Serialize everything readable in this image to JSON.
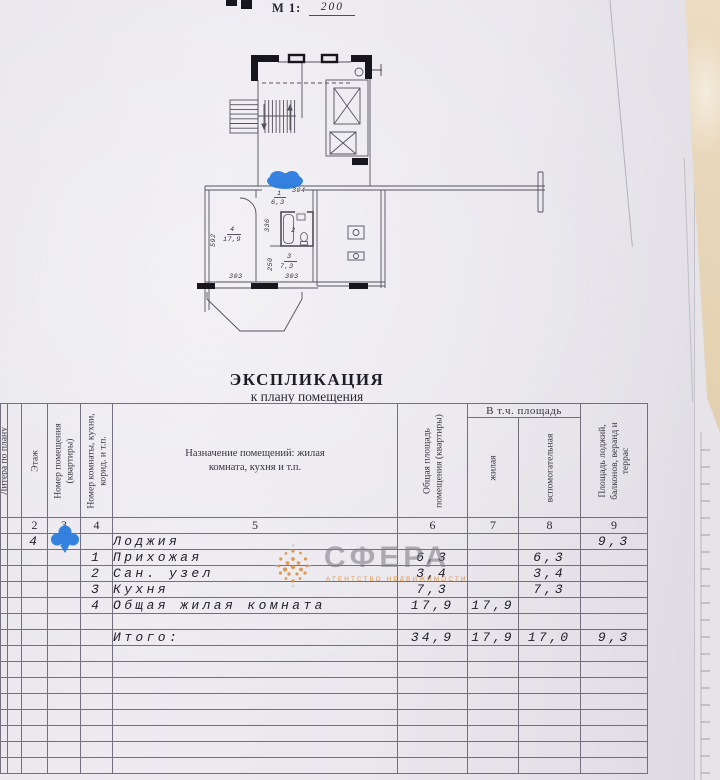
{
  "page": {
    "scale_label": "М 1:",
    "scale_value": "200",
    "title": "ЭКСПЛИКАЦИЯ",
    "subtitle": "к плану помещения"
  },
  "plan": {
    "labels": [
      {
        "t": "592",
        "x": 210,
        "y": 247,
        "r": 1
      },
      {
        "t": "4",
        "x": 230,
        "y": 226
      },
      {
        "t": "17,9",
        "x": 223,
        "y": 236
      },
      {
        "t": "303",
        "x": 229,
        "y": 273
      },
      {
        "t": "1",
        "x": 277,
        "y": 190
      },
      {
        "t": "6,3",
        "x": 271,
        "y": 199
      },
      {
        "t": "304",
        "x": 292,
        "y": 187
      },
      {
        "t": "336",
        "x": 264,
        "y": 232,
        "r": 1
      },
      {
        "t": "2",
        "x": 291,
        "y": 227
      },
      {
        "t": "250",
        "x": 267,
        "y": 271,
        "r": 1
      },
      {
        "t": "3",
        "x": 287,
        "y": 253
      },
      {
        "t": "7,3",
        "x": 280,
        "y": 263
      },
      {
        "t": "303",
        "x": 285,
        "y": 273
      }
    ]
  },
  "watermark": {
    "name": "СФЕРА",
    "tagline": "АГЕНТСТВО НЕДВИЖИМОСТИ"
  },
  "table": {
    "group_header": "В т.ч. площадь",
    "columns": {
      "c1": "Литера по плану",
      "c2": "Этаж",
      "c3": "Номер помещения\n(квартиры)",
      "c4": "Номер комнаты, кухни,\nкорид. и т.п.",
      "c5": "Назначение помещений: жилая\nкомната, кухня и т.п.",
      "c6": "Общая площадь\nпомещения (квартиры)",
      "c7": "жилая",
      "c8": "вспомогательная",
      "c9": "Площадь лоджий,\nбалконов, веранд и\nтеррас"
    },
    "column_numbers": [
      "2",
      "3",
      "4",
      "5",
      "6",
      "7",
      "8",
      "9"
    ],
    "rows": [
      {
        "floor": "4",
        "name": "Лоджия",
        "balcony": "9,3",
        "marker": true
      },
      {
        "room": "1",
        "name": "Прихожая",
        "total": "6,3",
        "aux": "6,3"
      },
      {
        "room": "2",
        "name": "Сан. узел",
        "total": "3,4",
        "aux": "3,4"
      },
      {
        "room": "3",
        "name": "Кухня",
        "total": "7,3",
        "aux": "7,3"
      },
      {
        "room": "4",
        "name": "Общая жилая комната",
        "total": "17,9",
        "living": "17,9"
      },
      {},
      {
        "name": "Итого:",
        "total": "34,9",
        "living": "17,9",
        "aux": "17,0",
        "balcony": "9,3"
      },
      {},
      {},
      {},
      {},
      {},
      {},
      {},
      {}
    ]
  },
  "colors": {
    "marker_blue": "#2b7ce0",
    "watermark_orange": "#dd8a35",
    "plan_line": "#54515d",
    "paper": "#eae8ed"
  }
}
